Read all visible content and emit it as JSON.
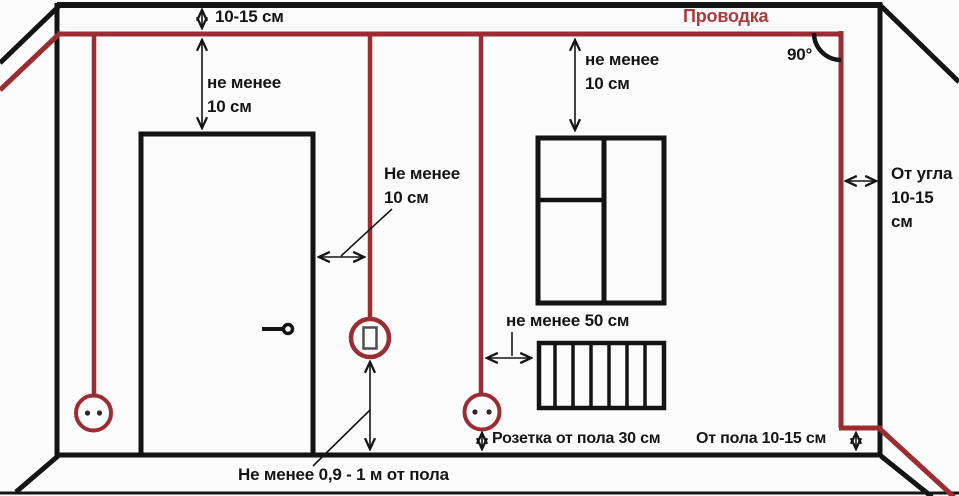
{
  "colors": {
    "wire": "#9b2c31",
    "wire_label": "#ad393c",
    "wall": "#141414",
    "text": "#151515",
    "background": "#fcfcfc"
  },
  "labels": {
    "wiring_title": "Проводка",
    "ceiling_gap": "10-15 см",
    "wire_to_door_top": "не менее\n10 см",
    "window_top_clearance": "не менее\n10 см",
    "angle": "90°",
    "door_side_clearance": "Не менее\n10 см",
    "corner_offset": "От угла\n10-15 см",
    "radiator_clearance": "не менее 50 см",
    "socket_height": "Розетка от пола 30 см",
    "floor_offset": "От пола 10-15 см",
    "switch_height": "Не менее 0,9 - 1 м от пола"
  },
  "icons": {
    "socket": "circle with two contact dots",
    "switch": "circle with rocker rectangle",
    "angle_arc": "quarter-circle angle mark"
  }
}
